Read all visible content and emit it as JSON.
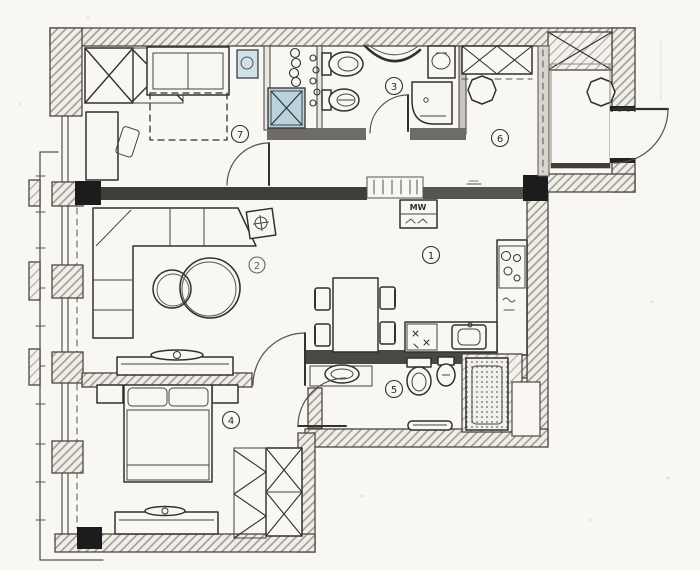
{
  "title": "apartment-floor-plan-sketch",
  "annotations": {
    "microwave": "MW"
  },
  "colors": {
    "paper": "#f8f7f4",
    "ink": "#33312d",
    "wall_dark": "#3f3e3a",
    "wall_black": "#1c1c1c",
    "wall_mid": "#6e6c66",
    "hatch": "#a39f92",
    "accent_blue": "#b9d3de",
    "accent_blue_light": "#cfe2ea"
  },
  "rooms": [
    {
      "label": "1",
      "name": "kitchen-dining"
    },
    {
      "label": "2",
      "name": "living-room"
    },
    {
      "label": "3",
      "name": "bathroom-top"
    },
    {
      "label": "4",
      "name": "bedroom-bottom"
    },
    {
      "label": "5",
      "name": "bathroom-bottom"
    },
    {
      "label": "6",
      "name": "entrance-hall"
    },
    {
      "label": "7",
      "name": "bedroom-top"
    }
  ]
}
